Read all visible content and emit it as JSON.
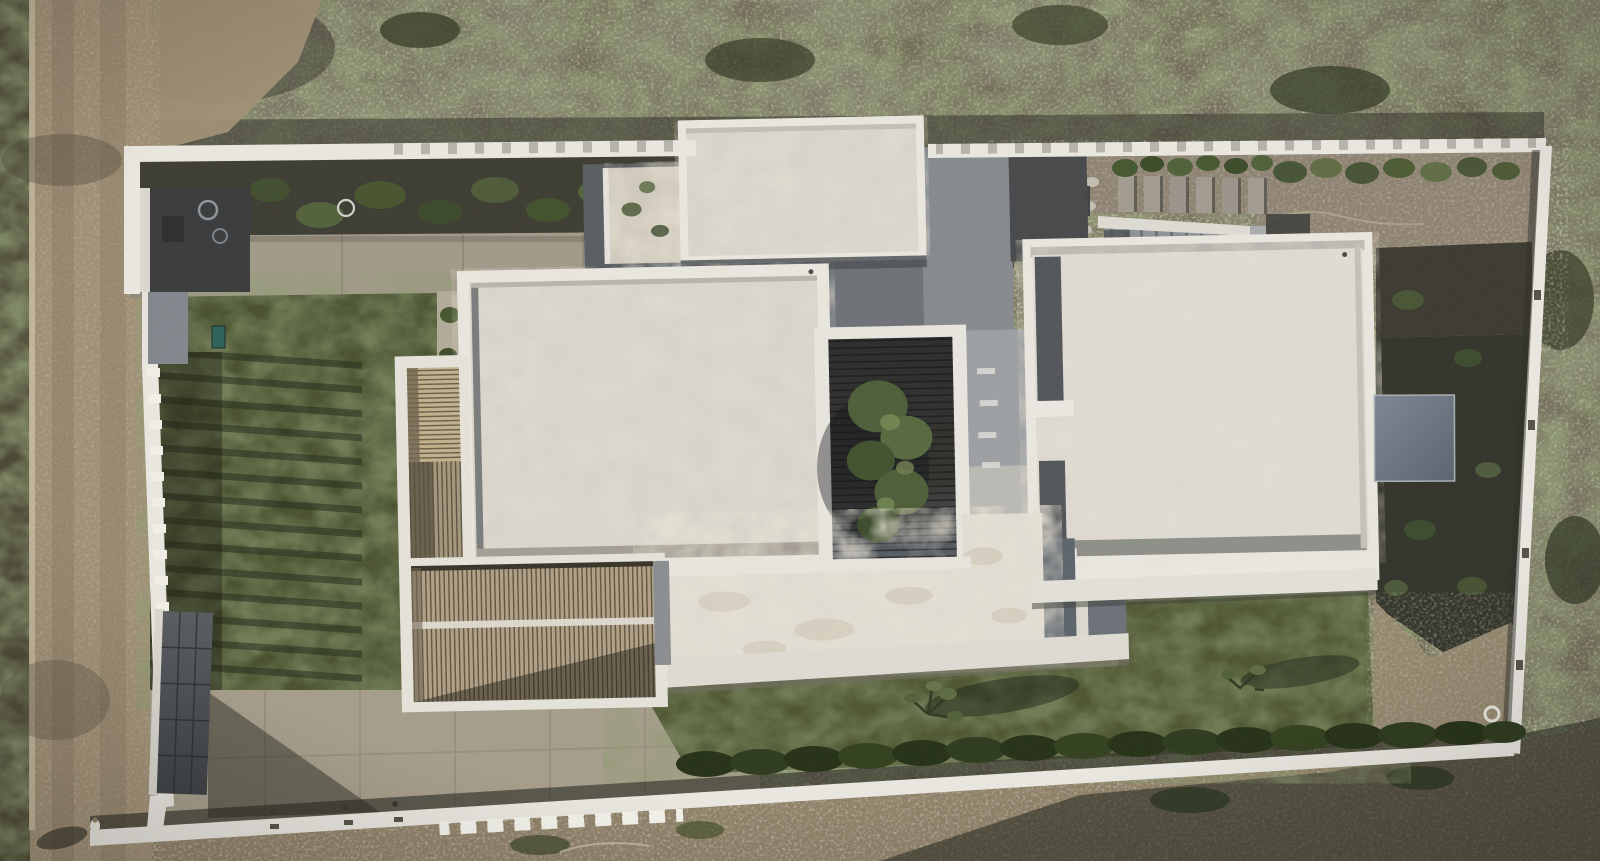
{
  "meta": {
    "title": "Aerial top-down drone photograph of a modern white villa",
    "kind": "natural-image",
    "view": "orthographic top-down",
    "time_of_day": "late afternoon, long shadows to north-east"
  },
  "colors": {
    "scrub": "#6b6550",
    "scrubShade": "#35342b",
    "road": "#a08f75",
    "roadEdge": "#43402f",
    "curb": "#c9bba0",
    "dirtOutside": "#8f8169",
    "dirtSE": "#93876e",
    "gravelNE": "#8d8272",
    "charcoalGravel": "#4b4c47",
    "bed": "#3e3d33",
    "concrete": "#a29a89",
    "apron": "#a69d8b",
    "grassWest": "#49512f",
    "grassEast": "#4d5531",
    "mulch": "#33342b",
    "wall": "#e9e7e0",
    "cap": "#f4f3ec",
    "parapet": "#eae7e1",
    "roofField": "#d9d4cb",
    "roofFieldC": "#ded9d1",
    "roofBright": "#e1dcd2",
    "lowerTerrace": "#dedbd3",
    "pebblePanel": "#cfc9bc",
    "terraceGray": "#868a8e",
    "terraceDark": "#5a5d61",
    "terraceMid": "#6e7277",
    "terraceStrip": "#9da0a3",
    "charcoalZone": "#47494b",
    "courtFrame": "#e8e5df",
    "deckWood": "#b1a084",
    "deckFrame": "#e5e2da",
    "deckBright": "#c3b08c",
    "grayStrip": "#8b8e90",
    "slate": "#5d646b",
    "stair": "#8f9398",
    "hedge": "#263218",
    "treeGreen": "#57693f",
    "teal": "#2e6158",
    "pebbleStrip": "#b3ab99",
    "stone": "#c3beb2",
    "person": "#e9e6da"
  },
  "scene": {
    "regions": [
      {
        "name": "dirt-road-west",
        "desc": "unpaved road along left edge with tyre tracks and light curb line"
      },
      {
        "name": "scrubland",
        "desc": "dry brush terrain surrounding the plot on north and east"
      },
      {
        "name": "boundary-walls",
        "desc": "low white walls with square post caps enclosing the plot"
      },
      {
        "name": "entry-gate",
        "desc": "dark grey garage gate and entry volume on the west wall"
      },
      {
        "name": "west-lawn",
        "desc": "lawn with diagonal fence-post shadows"
      },
      {
        "name": "timber-deck",
        "desc": "L-shaped slatted wooden pergola deck"
      },
      {
        "name": "roof-west-wing",
        "desc": "large white flat roof with parapet"
      },
      {
        "name": "roof-east-wing",
        "desc": "large white flat roof with parapet and skylight beside it"
      },
      {
        "name": "roof-north-block",
        "desc": "small white roof block over the entrance"
      },
      {
        "name": "roof-south-wing",
        "desc": "bright mottled lower roof"
      },
      {
        "name": "courtyard",
        "desc": "sunken dark-timber patio with a green tree"
      },
      {
        "name": "ne-yard",
        "desc": "gravel yard with stone mosaic, concrete pavers and an external stair"
      },
      {
        "name": "east-lawn",
        "desc": "lawn with two young olive trees and hedge along south wall"
      },
      {
        "name": "mulch-bed",
        "desc": "dark planted bed along the east wall"
      },
      {
        "name": "pedestrian",
        "desc": "person walking on the road at bottom left"
      }
    ]
  }
}
